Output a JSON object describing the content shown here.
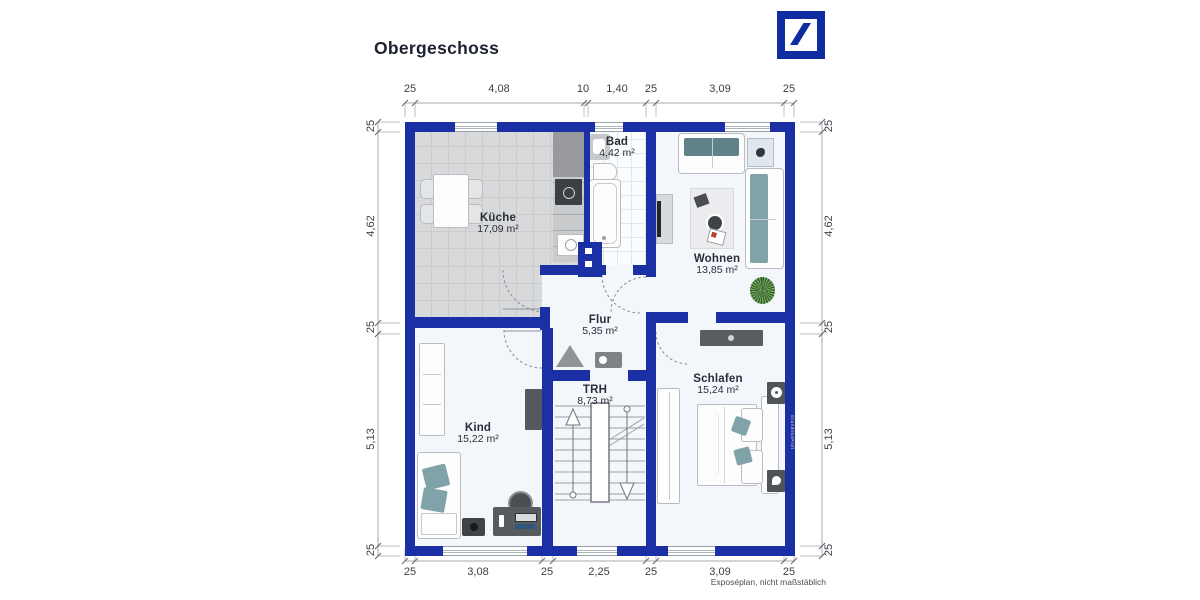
{
  "title": "Obergeschoss",
  "logo": {
    "name": "Deutsche Bank"
  },
  "plan": {
    "rooms": [
      {
        "id": "kueche",
        "label": "Küche",
        "area": "17,09 m²"
      },
      {
        "id": "bad",
        "label": "Bad",
        "area": "4,42 m²"
      },
      {
        "id": "wohnen",
        "label": "Wohnen",
        "area": "13,85 m²"
      },
      {
        "id": "flur",
        "label": "Flur",
        "area": "5,35 m²"
      },
      {
        "id": "trh",
        "label": "TRH",
        "area": "8,73 m²"
      },
      {
        "id": "kind",
        "label": "Kind",
        "area": "15,22 m²"
      },
      {
        "id": "schlafen",
        "label": "Schlafen",
        "area": "15,24 m²"
      }
    ],
    "dimensions": {
      "top": [
        "25",
        "4,08",
        "10",
        "1,40",
        "25",
        "3,09",
        "25"
      ],
      "bottom": [
        "25",
        "3,08",
        "25",
        "2,25",
        "25",
        "3,09",
        "25"
      ],
      "left": [
        "25",
        "4,62",
        "25",
        "5,13",
        "25"
      ],
      "right": [
        "25",
        "4,62",
        "25",
        "5,13",
        "25"
      ]
    },
    "watermark": "GrundrissProfi"
  },
  "footer": {
    "note": "Exposéplan, nicht maßstäblich"
  },
  "colors": {
    "wall": "#1b30a4",
    "logo": "#0f2da0",
    "floor": "#f3f6fa",
    "tile": "#d8d9db",
    "teal": "#7fa3a8",
    "teal-dark": "#5e8287"
  }
}
